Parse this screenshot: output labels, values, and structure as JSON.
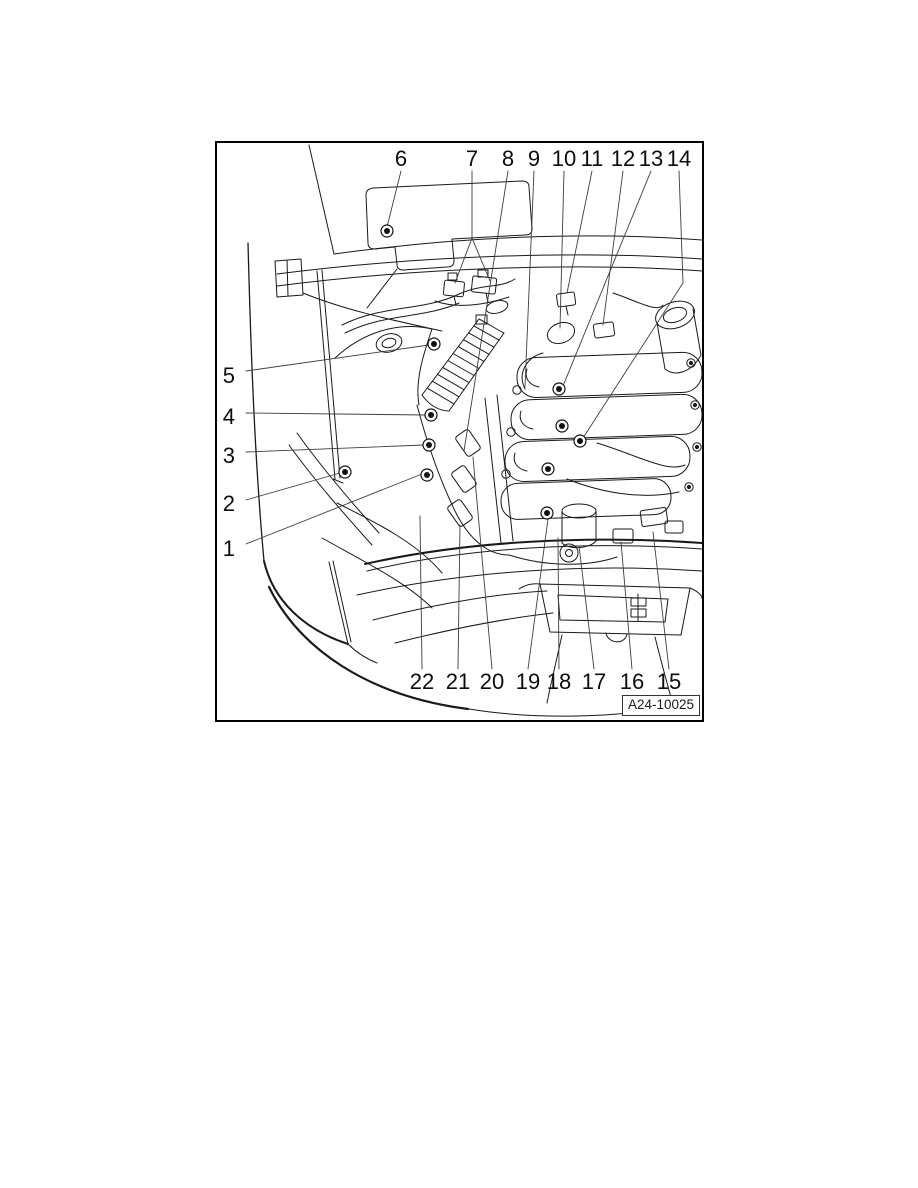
{
  "figure": {
    "description": "engine-compartment-component-location-diagram",
    "code": "A24-10025",
    "callouts": {
      "n1": "1",
      "n2": "2",
      "n3": "3",
      "n4": "4",
      "n5": "5",
      "n6": "6",
      "n7": "7",
      "n8": "8",
      "n9": "9",
      "n10": "10",
      "n11": "11",
      "n12": "12",
      "n13": "13",
      "n14": "14",
      "n15": "15",
      "n16": "16",
      "n17": "17",
      "n18": "18",
      "n19": "19",
      "n20": "20",
      "n21": "21",
      "n22": "22"
    }
  },
  "colors": {
    "frame_border": "#000000",
    "line_art": "#1a1a1a",
    "leader_line": "#3d3d3d",
    "background": "#ffffff"
  }
}
